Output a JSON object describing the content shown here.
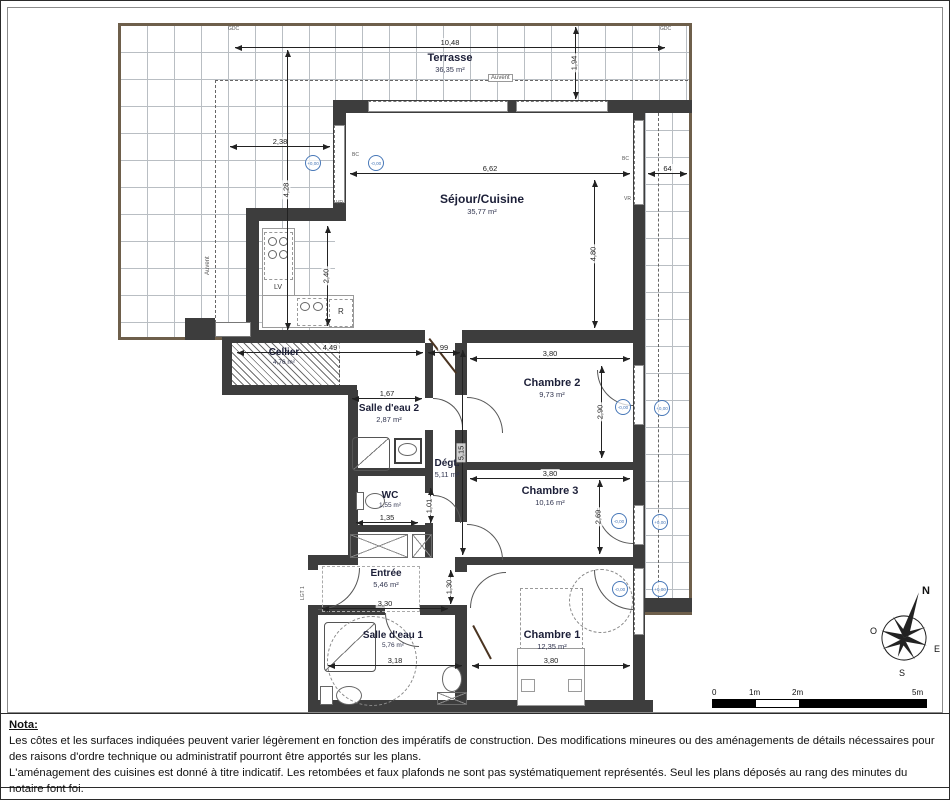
{
  "rooms": {
    "terrasse": {
      "name": "Terrasse",
      "area": "36,35 m²"
    },
    "sejour": {
      "name": "Séjour/Cuisine",
      "area": "35,77 m²"
    },
    "cellier": {
      "name": "Cellier",
      "area": "4,76 m²"
    },
    "sde2": {
      "name": "Salle d'eau 2",
      "area": "2,87 m²"
    },
    "degt": {
      "name": "Dégt.",
      "area": "5,11 m²"
    },
    "wc": {
      "name": "WC",
      "area": "1,55 m²"
    },
    "entree": {
      "name": "Entrée",
      "area": "5,46 m²"
    },
    "sde1": {
      "name": "Salle d'eau 1",
      "area": "5,76 m²"
    },
    "ch1": {
      "name": "Chambre 1",
      "area": "12,35 m²"
    },
    "ch2": {
      "name": "Chambre 2",
      "area": "9,73 m²"
    },
    "ch3": {
      "name": "Chambre 3",
      "area": "10,16 m²"
    }
  },
  "dims": {
    "d10_48": "10,48",
    "d1_94": "1,94",
    "d2_38": "2,38",
    "d4_28": "4,28",
    "d6_62": "6,62",
    "d64": "64",
    "d4_80": "4,80",
    "d2_40": "2,40",
    "d4_49": "4,49",
    "d99": "99",
    "d3_80a": "3,80",
    "d2_90": "2,90",
    "d1_67": "1,67",
    "d3_80b": "3,80",
    "d2_69": "2,69",
    "d1_35": "1,35",
    "d1_01": "1,01",
    "d5_15": "5,15",
    "d3_30": "3,30",
    "d1_30": "1,30",
    "d3_18": "3,18",
    "d3_80c": "3,80"
  },
  "annotations": {
    "gdc": "GDC",
    "auvent": "Auvent",
    "bc": "BC",
    "vr": "VR",
    "lgt": "LGT 1",
    "lv": "LV",
    "fridge": "R",
    "level_minus": "-0,00",
    "level_plus": "+0,00"
  },
  "compass": {
    "n": "N",
    "s": "S",
    "e": "E",
    "o": "O"
  },
  "scalebar": {
    "t0": "0",
    "t1": "1m",
    "t2": "2m",
    "t5": "5m"
  },
  "nota": {
    "title": "Nota:",
    "p1": "Les côtes et les surfaces indiquées peuvent varier légèrement en fonction des impératifs de construction. Des modifications mineures ou des aménagements de détails nécessaires pour des raisons d'ordre technique ou administratif pourront être apportés sur les plans.",
    "p2": "L'aménagement des cuisines est donné à titre indicatif. Les retombées et faux plafonds ne sont pas systématiquement représentés. Seul les plans déposés au rang des minutes du notaire font foi."
  },
  "colors": {
    "wall": "#3d3d3d",
    "level_blue": "#4878b8",
    "terrace_rim": "#6e5f4b"
  }
}
